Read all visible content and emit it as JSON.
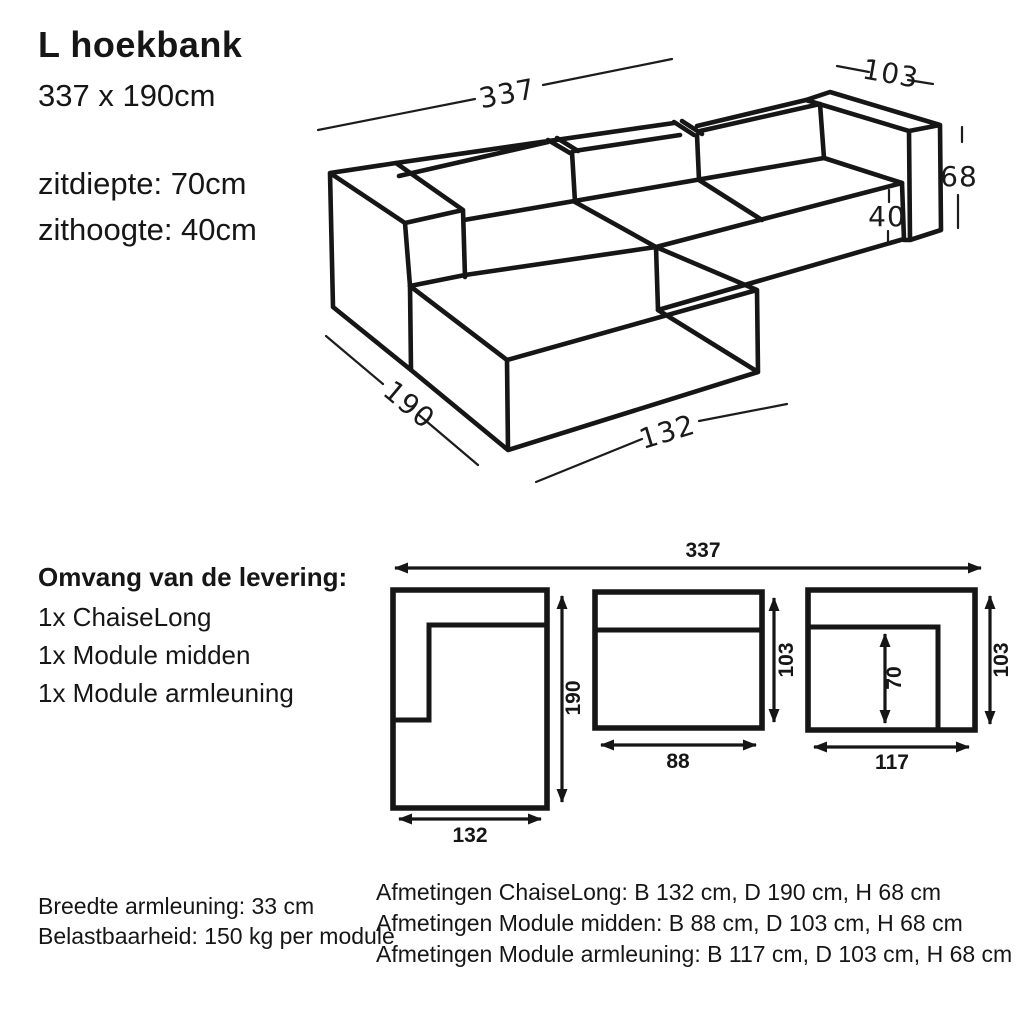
{
  "header": {
    "title": "L hoekbank",
    "size": "337 x 190cm",
    "seat_depth": "zitdiepte: 70cm",
    "seat_height": "zithoogte: 40cm"
  },
  "iso_diagram": {
    "length": "337",
    "module_depth": "103",
    "height": "68",
    "seat_height": "40",
    "chaise_depth": "190",
    "chaise_width": "132"
  },
  "delivery": {
    "heading": "Omvang van de levering:",
    "items": [
      "1x ChaiseLong",
      "1x Module midden",
      "1x Module armleuning"
    ]
  },
  "plan_diagram": {
    "total_width": "337",
    "chaise_width": "132",
    "chaise_depth": "190",
    "midden_width": "88",
    "midden_depth": "103",
    "armleuning_width": "117",
    "armleuning_depth": "103",
    "armleuning_seat_depth": "70"
  },
  "notes_left": [
    "Breedte armleuning: 33 cm",
    "Belastbaarheid: 150 kg per module"
  ],
  "notes_right": [
    "Afmetingen ChaiseLong: B 132 cm, D 190 cm, H 68 cm",
    "Afmetingen Module midden: B 88 cm, D 103 cm, H 68 cm",
    "Afmetingen Module armleuning: B 117 cm, D 103 cm, H 68 cm"
  ],
  "colors": {
    "ink": "#161616",
    "background": "#ffffff"
  }
}
